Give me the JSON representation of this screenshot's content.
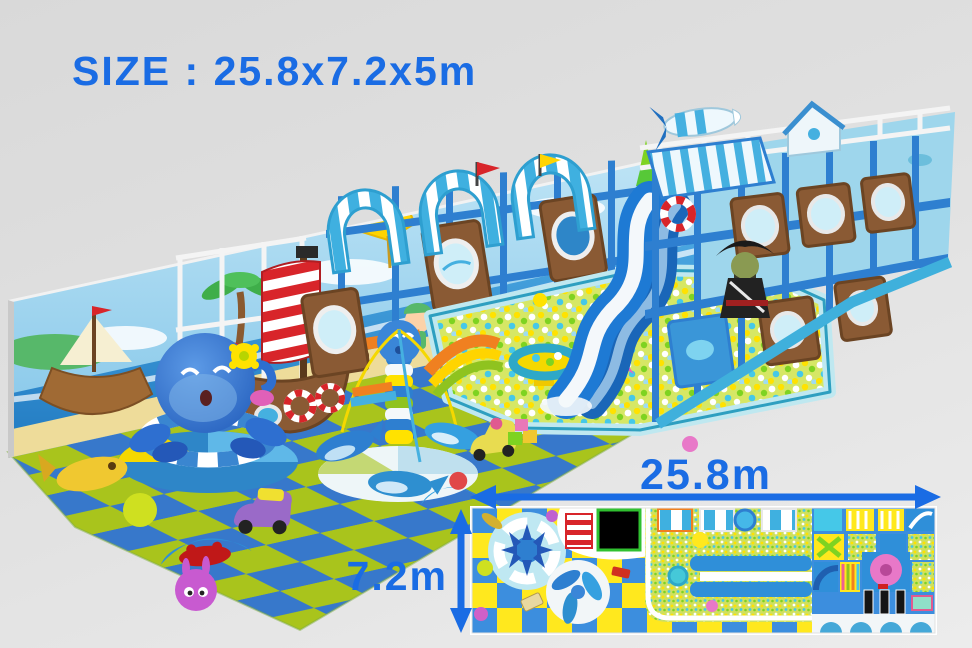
{
  "title": {
    "text": "SIZE : 25.8x7.2x5m"
  },
  "plan": {
    "width_label": "25.8m",
    "depth_label": "7.2m"
  },
  "palette": {
    "accent": "#1a6ce4",
    "bg-top": "#d9d9d9",
    "bg-bottom": "#ececec",
    "mat-blue": "#3778cb",
    "mat-green": "#a9c41c",
    "plan-yellow": "#ffe81e",
    "plan-blue": "#3c8ede",
    "frame-blue": "#2e7fd0",
    "canopy-teal": "#3fb0e0",
    "wood-brown": "#8a5a34",
    "sail-red": "#d8252a",
    "pit-base": "#d6e765",
    "slide-blue": "#1e7ad4"
  },
  "scene": {
    "objects": [
      "wall-mural-beach-pirate-kids",
      "pirate-ship-play-boat",
      "octopus-ride",
      "dolphin-carousel",
      "striped-arch-canopies",
      "ocean-ball-pit",
      "double-wave-slide",
      "two-level-play-structure",
      "pirate-figure",
      "rocket-toy",
      "checkered-floor-mats",
      "toy-car",
      "crab-rocker",
      "bunny-ball",
      "fish-rocker",
      "scooter-toy"
    ]
  }
}
